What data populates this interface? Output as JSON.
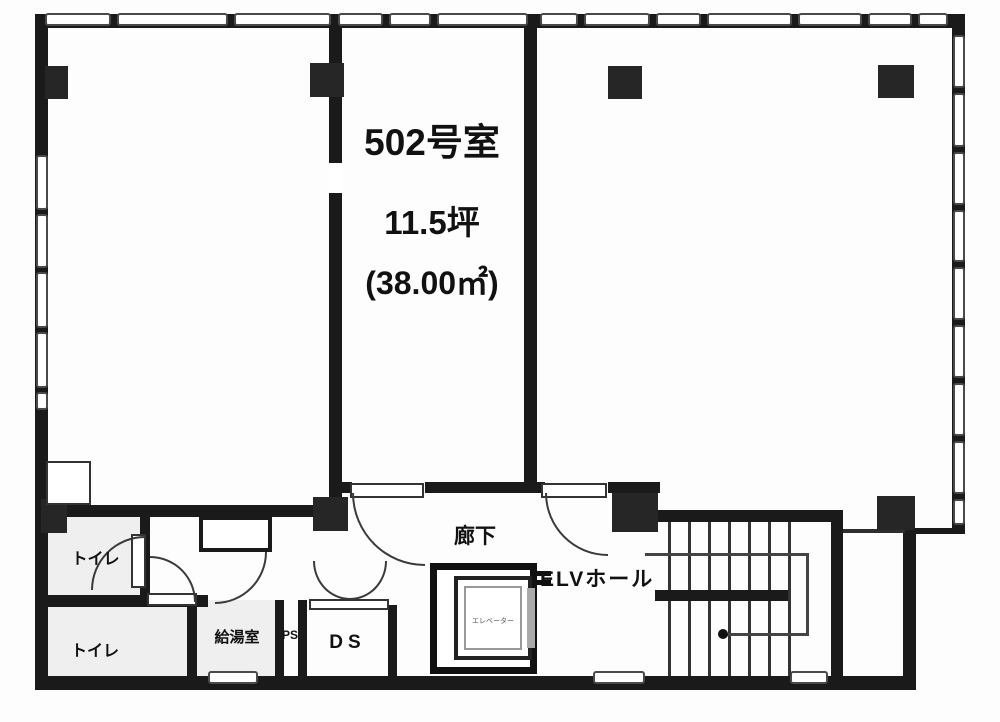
{
  "unit": {
    "room_label": "502号室",
    "area_tsubo": "11.5坪",
    "area_m2": "(38.00㎡)"
  },
  "labels": {
    "corridor": "廊下",
    "elevator_hall": "ELVホール",
    "elevator": "エレベーター",
    "duct_space": "DS",
    "kitchenette": "給湯室",
    "pipe_space": "PS",
    "toilet_upper": "トイレ",
    "toilet_lower": "トイレ"
  },
  "colors": {
    "wall": "#1a1a1a",
    "background": "#ffffff"
  }
}
